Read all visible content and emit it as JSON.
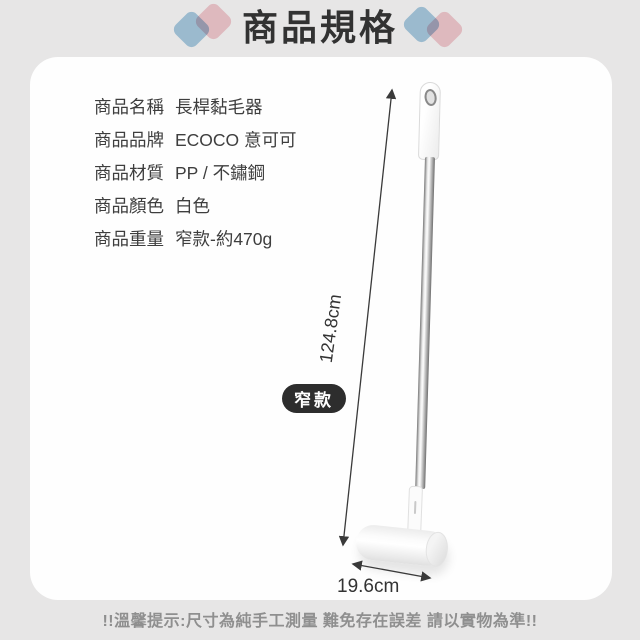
{
  "header": {
    "title": "商品規格"
  },
  "specs": {
    "rows": [
      {
        "label": "商品名稱",
        "value": "長桿黏毛器"
      },
      {
        "label": "商品品牌",
        "value": "ECOCO 意可可"
      },
      {
        "label": "商品材質",
        "value": "PP / 不鏽鋼"
      },
      {
        "label": "商品顏色",
        "value": "白色"
      },
      {
        "label": "商品重量",
        "value": "窄款-約470g"
      }
    ]
  },
  "figure": {
    "length_label": "124.8cm",
    "width_label": "19.6cm",
    "variant_badge": "窄款"
  },
  "footer": {
    "disclaimer": "!!溫馨提示:尺寸為純手工測量 難免存在誤差 請以實物為準!!"
  },
  "colors": {
    "background": "#e7e6e6",
    "card": "#fefefe",
    "accent_blue": "#abcfe5",
    "accent_pink": "#f5cdd3",
    "badge_bg": "#2d2d2d",
    "text_dark": "#3e3e3e",
    "text_muted": "#8f8f8f"
  }
}
